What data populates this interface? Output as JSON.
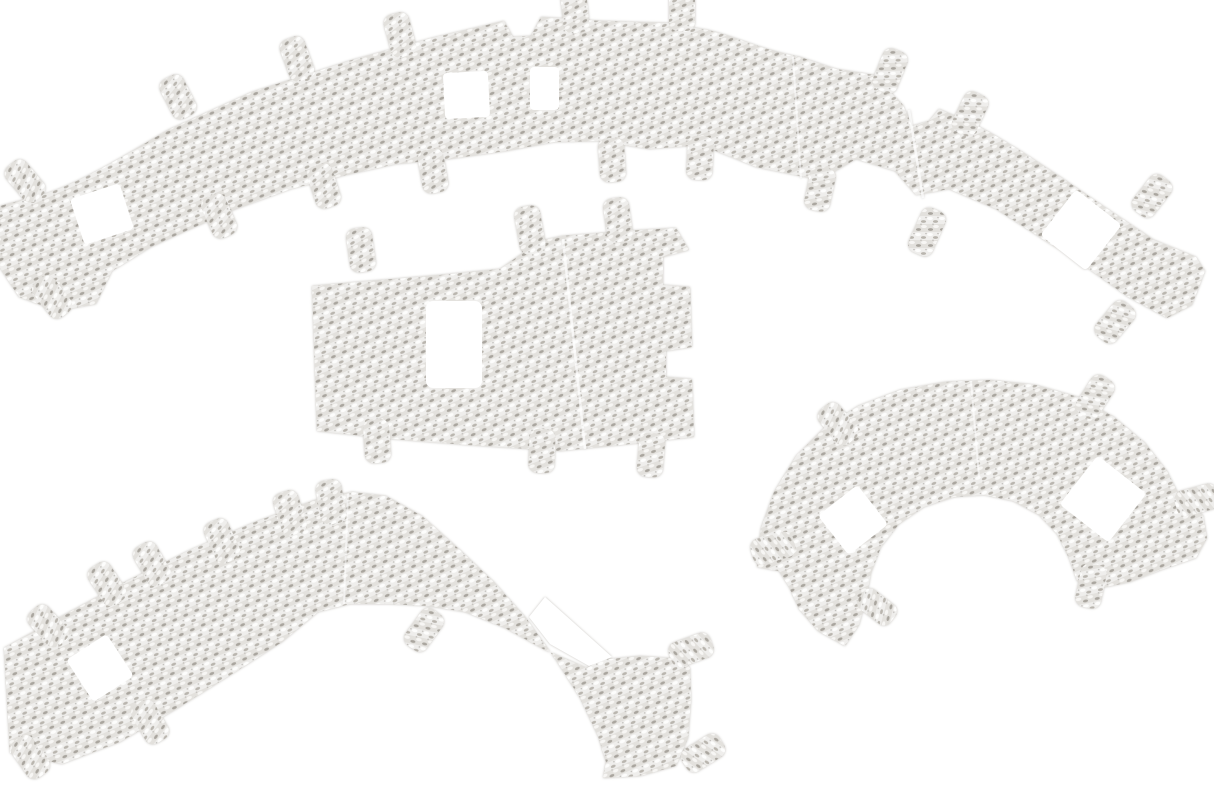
{
  "page": {
    "background_color": "#ffffff"
  },
  "product_photo": {
    "alt": "Four embossed aluminium heat shield panels with mounting tabs and square cut-outs on a white background",
    "finish": "diagonally embossed aluminium weave",
    "piece_count": "4",
    "colors": {
      "background": "#ffffff",
      "base_light": "#efeeec",
      "base_dark": "#e3e1dd",
      "highlight": "#fdfdfc",
      "highlight_soft": "#f7f6f4",
      "shadow": "#b9b5ae",
      "shadow_deep": "#a9a59e",
      "speck": "#8e8a84",
      "edge_halo": "#c2bfb9",
      "hole": "#ffffff",
      "seam": "#ffffff"
    },
    "pieces": [
      {
        "name": "top-strip",
        "label": "Long contoured heat shield strip with mounting tabs and four square cut-outs"
      },
      {
        "name": "center-plate",
        "label": "Rectangular heat shield plate with one rectangular cut-out, edge notches and mounting tabs"
      },
      {
        "name": "lower-left-strip",
        "label": "J-shaped curved heat shield strip with mounting tabs and one square cut-out"
      },
      {
        "name": "right-arch",
        "label": "Arched heat shield piece with two square cut-outs and mounting tabs"
      }
    ]
  }
}
